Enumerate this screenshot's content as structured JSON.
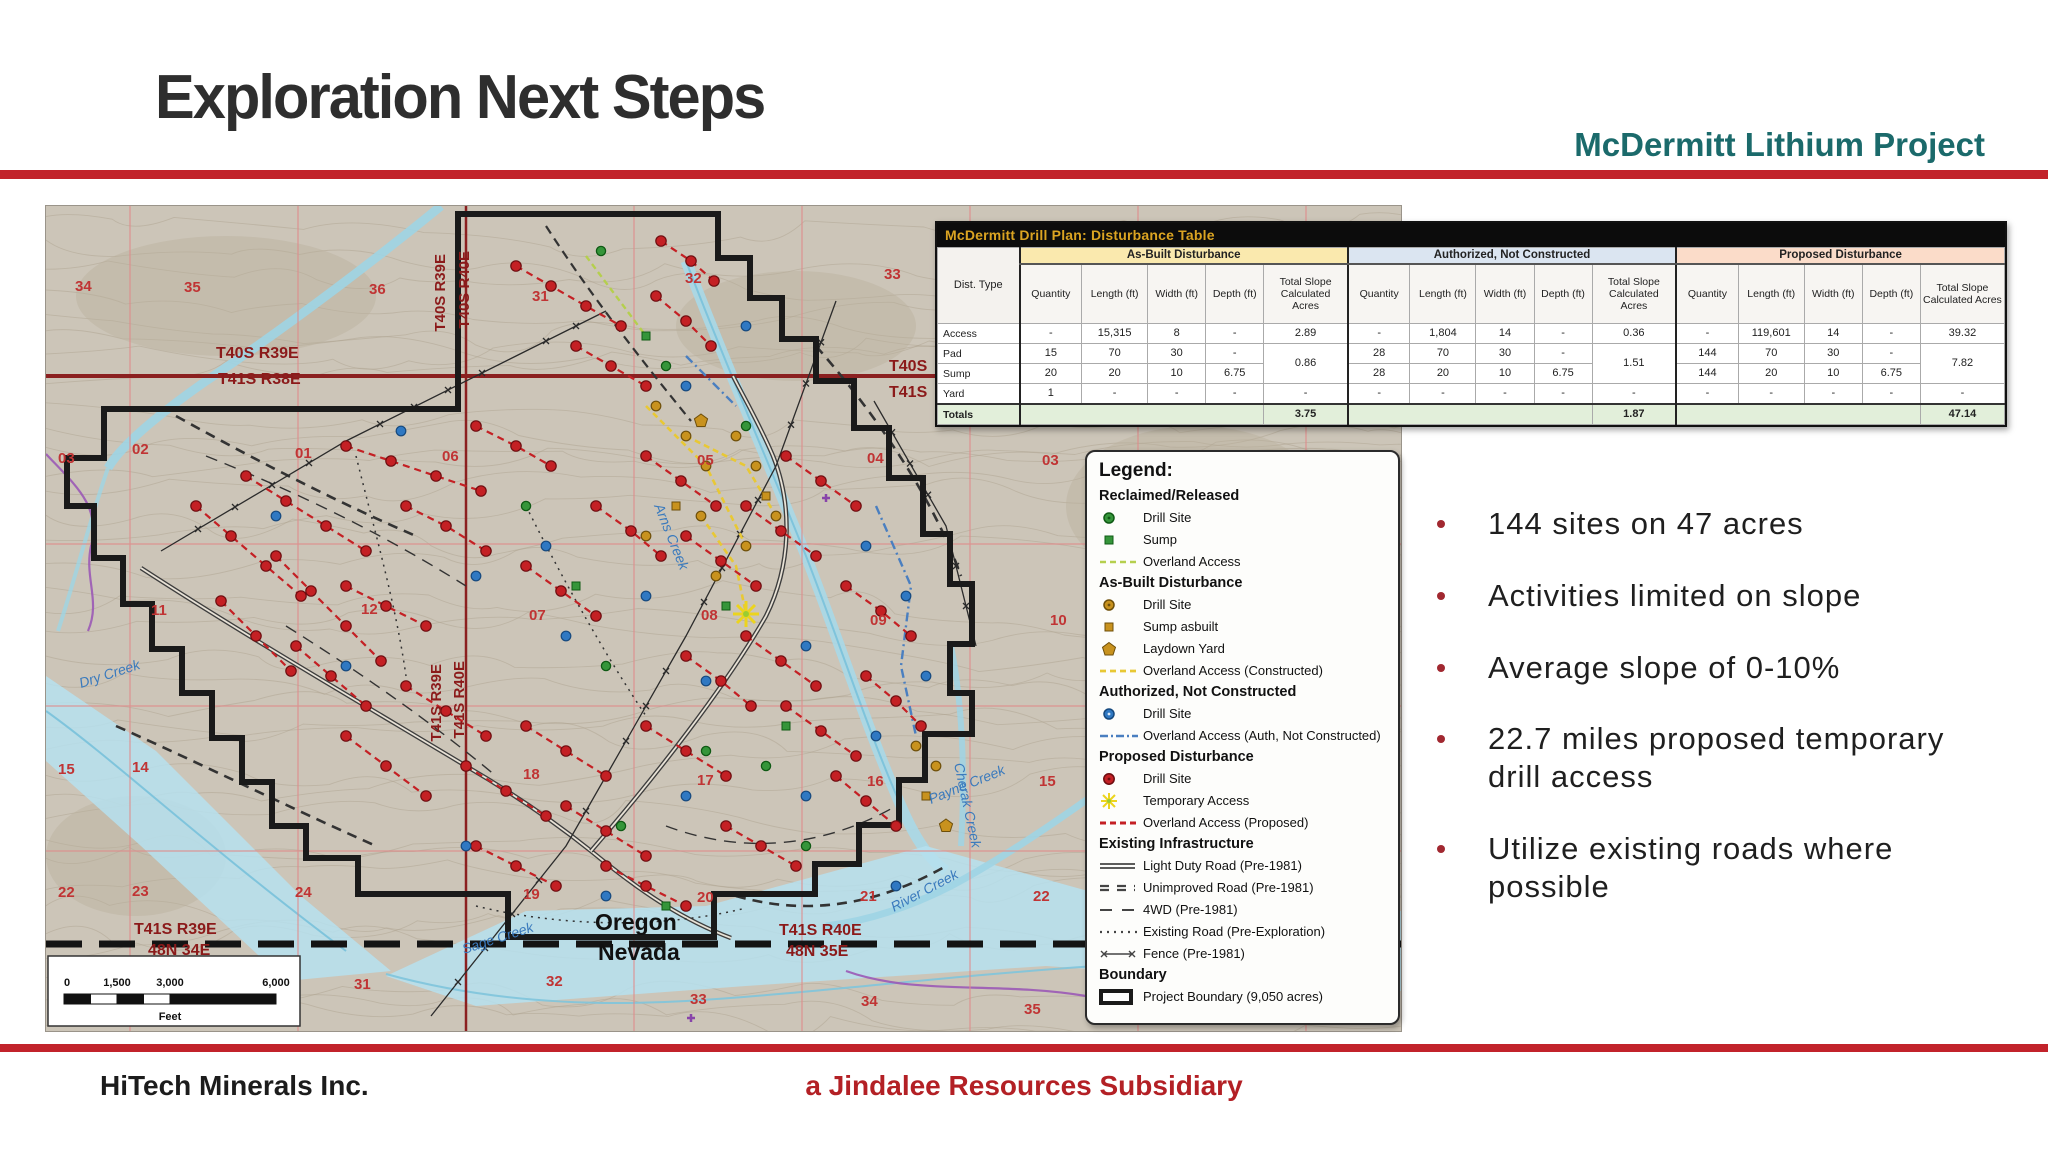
{
  "slide": {
    "title": "Exploration Next Steps",
    "subtitle": "McDermitt Lithium Project",
    "footer_left": "HiTech Minerals Inc.",
    "footer_center": "a Jindalee Resources Subsidiary",
    "accent_red": "#c2232b",
    "teal_color": "#1b6a6b",
    "footer_red": "#b32025"
  },
  "bullets": [
    "144 sites on 47 acres",
    "Activities limited on slope",
    "Average slope of 0-10%",
    "22.7 miles proposed temporary drill access",
    "Utilize existing roads where possible"
  ],
  "table": {
    "title": "McDermitt Drill Plan: Disturbance Table",
    "row_header": "Dist. Type",
    "groups": [
      {
        "name": "As-Built Disturbance",
        "color": "#fae9ae"
      },
      {
        "name": "Authorized, Not Constructed",
        "color": "#dbe5f1"
      },
      {
        "name": "Proposed Disturbance",
        "color": "#fbdcc9"
      }
    ],
    "sub_columns": [
      "Quantity",
      "Length (ft)",
      "Width (ft)",
      "Depth (ft)",
      "Total Slope Calculated Acres"
    ],
    "rows": [
      {
        "label": "Access",
        "cells": [
          [
            "-",
            "15,315",
            "8",
            "-"
          ],
          [
            "-",
            "1,804",
            "14",
            "-"
          ],
          [
            "-",
            "119,601",
            "14",
            "-"
          ]
        ],
        "totals": [
          "2.89",
          "0.36",
          "39.32"
        ],
        "total_rowspan": 1
      },
      {
        "label": "Pad",
        "cells": [
          [
            "15",
            "70",
            "30",
            "-"
          ],
          [
            "28",
            "70",
            "30",
            "-"
          ],
          [
            "144",
            "70",
            "30",
            "-"
          ]
        ],
        "totals": [
          "0.86",
          "1.51",
          "7.82"
        ],
        "total_rowspan": 2
      },
      {
        "label": "Sump",
        "cells": [
          [
            "20",
            "20",
            "10",
            "6.75"
          ],
          [
            "28",
            "20",
            "10",
            "6.75"
          ],
          [
            "144",
            "20",
            "10",
            "6.75"
          ]
        ],
        "totals": null
      },
      {
        "label": "Yard",
        "cells": [
          [
            "1",
            "-",
            "-",
            "-"
          ],
          [
            "-",
            "-",
            "-",
            "-"
          ],
          [
            "-",
            "-",
            "-",
            "-"
          ]
        ],
        "totals": [
          "-",
          "-",
          "-"
        ],
        "total_rowspan": 1
      }
    ],
    "totals_row": {
      "label": "Totals",
      "values": [
        "3.75",
        "1.87",
        "47.14"
      ]
    }
  },
  "legend": {
    "title": "Legend:",
    "sections": [
      {
        "heading": "Reclaimed/Released",
        "items": [
          {
            "icon": "green-drill-site",
            "label": "Drill Site"
          },
          {
            "icon": "green-sump",
            "label": "Sump"
          },
          {
            "icon": "green-dash",
            "label": "Overland Access"
          }
        ]
      },
      {
        "heading": "As-Built Disturbance",
        "items": [
          {
            "icon": "gold-drill-site",
            "label": "Drill Site"
          },
          {
            "icon": "gold-sump",
            "label": "Sump asbuilt"
          },
          {
            "icon": "gold-pentagon",
            "label": "Laydown Yard"
          },
          {
            "icon": "yellow-dash",
            "label": "Overland Access (Constructed)"
          }
        ]
      },
      {
        "heading": "Authorized, Not Constructed",
        "items": [
          {
            "icon": "blue-drill-site",
            "label": "Drill Site"
          },
          {
            "icon": "blue-dashdot",
            "label": "Overland Access (Auth, Not Constructed)"
          }
        ]
      },
      {
        "heading": "Proposed Disturbance",
        "items": [
          {
            "icon": "red-drill-site",
            "label": "Drill Site"
          },
          {
            "icon": "yellow-star",
            "label": "Temporary Access"
          },
          {
            "icon": "red-dash",
            "label": "Overland Access (Proposed)"
          }
        ]
      },
      {
        "heading": "Existing Infrastructure",
        "items": [
          {
            "icon": "double-line",
            "label": "Light Duty Road (Pre-1981)"
          },
          {
            "icon": "double-dash",
            "label": "Unimproved Road (Pre-1981)"
          },
          {
            "icon": "long-dash",
            "label": "4WD (Pre-1981)"
          },
          {
            "icon": "dotted",
            "label": "Existing Road (Pre-Exploration)"
          },
          {
            "icon": "fence",
            "label": "Fence (Pre-1981)"
          }
        ]
      },
      {
        "heading": "Boundary",
        "items": [
          {
            "icon": "boundary-box",
            "label": "Project Boundary (9,050 acres)"
          }
        ]
      }
    ]
  },
  "map": {
    "section_numbers": [
      {
        "n": "34",
        "x": 29,
        "y": 85
      },
      {
        "n": "35",
        "x": 138,
        "y": 86
      },
      {
        "n": "36",
        "x": 323,
        "y": 88
      },
      {
        "n": "31",
        "x": 486,
        "y": 95
      },
      {
        "n": "32",
        "x": 639,
        "y": 77
      },
      {
        "n": "33",
        "x": 838,
        "y": 73
      },
      {
        "n": "03",
        "x": 12,
        "y": 257
      },
      {
        "n": "02",
        "x": 86,
        "y": 248
      },
      {
        "n": "01",
        "x": 249,
        "y": 252
      },
      {
        "n": "06",
        "x": 396,
        "y": 255
      },
      {
        "n": "05",
        "x": 651,
        "y": 259
      },
      {
        "n": "04",
        "x": 821,
        "y": 257
      },
      {
        "n": "03",
        "x": 996,
        "y": 259
      },
      {
        "n": "11",
        "x": 105,
        "y": 409
      },
      {
        "n": "12",
        "x": 315,
        "y": 408
      },
      {
        "n": "07",
        "x": 483,
        "y": 414
      },
      {
        "n": "08",
        "x": 655,
        "y": 414
      },
      {
        "n": "09",
        "x": 824,
        "y": 419
      },
      {
        "n": "10",
        "x": 1004,
        "y": 419
      },
      {
        "n": "15",
        "x": 12,
        "y": 568
      },
      {
        "n": "14",
        "x": 86,
        "y": 566
      },
      {
        "n": "18",
        "x": 477,
        "y": 573
      },
      {
        "n": "17",
        "x": 651,
        "y": 579
      },
      {
        "n": "16",
        "x": 821,
        "y": 580
      },
      {
        "n": "15",
        "x": 993,
        "y": 580
      },
      {
        "n": "22",
        "x": 12,
        "y": 691
      },
      {
        "n": "23",
        "x": 86,
        "y": 690
      },
      {
        "n": "24",
        "x": 249,
        "y": 691
      },
      {
        "n": "19",
        "x": 477,
        "y": 693
      },
      {
        "n": "20",
        "x": 651,
        "y": 696
      },
      {
        "n": "21",
        "x": 814,
        "y": 695
      },
      {
        "n": "22",
        "x": 987,
        "y": 695
      },
      {
        "n": "31",
        "x": 308,
        "y": 783
      },
      {
        "n": "32",
        "x": 500,
        "y": 780
      },
      {
        "n": "33",
        "x": 644,
        "y": 798
      },
      {
        "n": "34",
        "x": 815,
        "y": 800
      },
      {
        "n": "35",
        "x": 978,
        "y": 808
      }
    ],
    "townships": [
      {
        "text": "T40S R39E",
        "x": 170,
        "y": 152
      },
      {
        "text": "T41S R38E",
        "x": 172,
        "y": 178
      },
      {
        "text": "T40S",
        "x": 843,
        "y": 165
      },
      {
        "text": "T41S",
        "x": 843,
        "y": 191
      },
      {
        "text": "T41S R39E",
        "x": 88,
        "y": 728
      },
      {
        "text": "48N 34E",
        "x": 102,
        "y": 749
      },
      {
        "text": "T41S R40E",
        "x": 733,
        "y": 729
      },
      {
        "text": "48N 35E",
        "x": 740,
        "y": 750
      }
    ],
    "vertical_labels": [
      {
        "text": "T40S R39E",
        "x": 399,
        "y": 48
      },
      {
        "text": "T40S R40E",
        "x": 423,
        "y": 45
      },
      {
        "text": "T41S R39E",
        "x": 395,
        "y": 458
      },
      {
        "text": "T41S R40E",
        "x": 418,
        "y": 455
      }
    ],
    "creeks": [
      {
        "text": "Dry Creek",
        "x": 35,
        "y": 482,
        "r": -18
      },
      {
        "text": "Arns Creek",
        "x": 608,
        "y": 300,
        "r": 68
      },
      {
        "text": "Payne Creek",
        "x": 885,
        "y": 598,
        "r": -22
      },
      {
        "text": "River Creek",
        "x": 848,
        "y": 706,
        "r": -28
      },
      {
        "text": "Sage Creek",
        "x": 418,
        "y": 748,
        "r": -18
      },
      {
        "text": "Cherak Creek",
        "x": 908,
        "y": 558,
        "r": 78
      }
    ],
    "states": [
      {
        "text": "Oregon",
        "x": 549,
        "y": 724
      },
      {
        "text": "Nevada",
        "x": 552,
        "y": 754
      }
    ],
    "scalebar": {
      "ticks": [
        "0",
        "1,500",
        "3,000",
        "6,000"
      ],
      "unit": "Feet"
    }
  }
}
